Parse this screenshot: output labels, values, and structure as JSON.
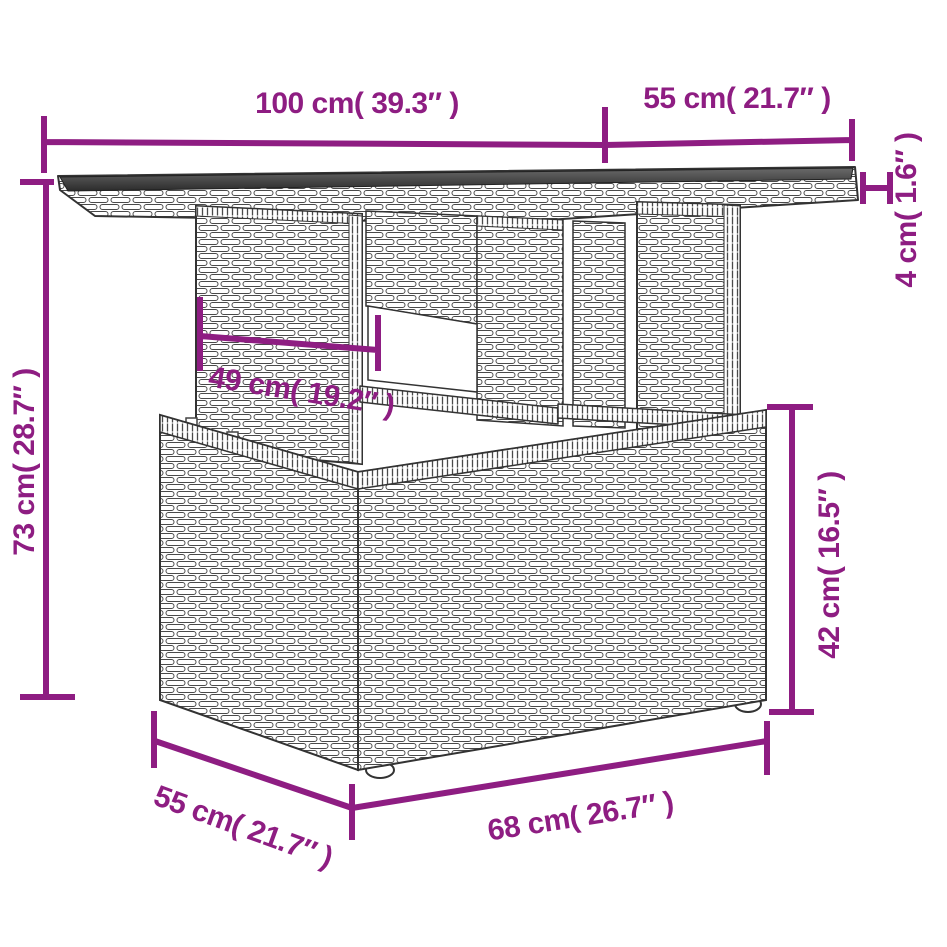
{
  "figure": {
    "accent_color": "#8e1d82",
    "line_color": "#333333",
    "glass_color": "#3d3d3d"
  },
  "dimensions": {
    "top_length": {
      "label": "100 cm( 39.3″ )",
      "cm": 100,
      "inches": 39.3
    },
    "top_depth": {
      "label": "55 cm( 21.7″ )",
      "cm": 55,
      "inches": 21.7
    },
    "top_thickness": {
      "label": "4 cm( 1.6″ )",
      "cm": 4,
      "inches": 1.6
    },
    "total_height": {
      "label": "73 cm( 28.7″ )",
      "cm": 73,
      "inches": 28.7
    },
    "pedestal_width": {
      "label": "49 cm( 19.2″ )",
      "cm": 49,
      "inches": 19.2
    },
    "base_height": {
      "label": "42 cm( 16.5″ )",
      "cm": 42,
      "inches": 16.5
    },
    "base_depth": {
      "label": "55 cm( 21.7″ )",
      "cm": 55,
      "inches": 21.7
    },
    "base_width": {
      "label": "68 cm( 26.7″ )",
      "cm": 68,
      "inches": 26.7
    }
  }
}
